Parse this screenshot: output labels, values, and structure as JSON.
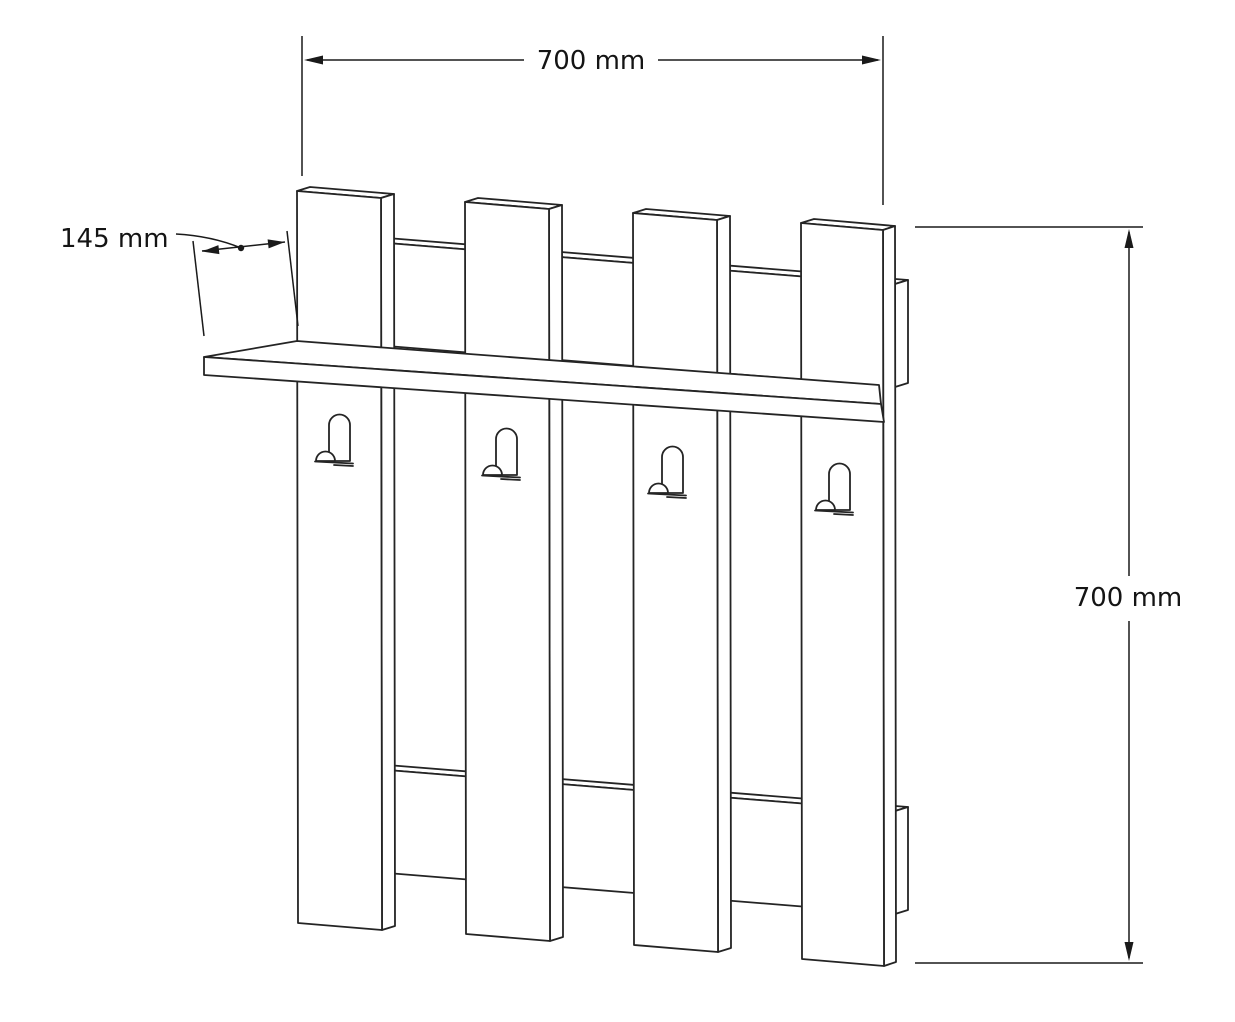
{
  "page": {
    "background": "#ffffff",
    "width_px": 1235,
    "height_px": 1022
  },
  "diagram": {
    "type": "technical-drawing",
    "subject": "Wall-mounted coat rack with shelf, four vertical slats, two back rails and four hooks",
    "style": "black line art in slight perspective on white background",
    "line_color": "#242424",
    "text_color": "#141414",
    "dimensions": [
      {
        "id": "overall-width",
        "label": "700 mm",
        "value": 700,
        "unit": "mm",
        "orientation": "horizontal",
        "position": "top"
      },
      {
        "id": "shelf-depth",
        "label": "145 mm",
        "value": 145,
        "unit": "mm",
        "orientation": "slanted-with-leader",
        "position": "upper-left"
      },
      {
        "id": "overall-height",
        "label": "700 mm",
        "value": 700,
        "unit": "mm",
        "orientation": "vertical",
        "position": "right"
      }
    ],
    "components": {
      "slats": 4,
      "hooks": 4,
      "back_rails": 2,
      "shelves": 1
    }
  }
}
